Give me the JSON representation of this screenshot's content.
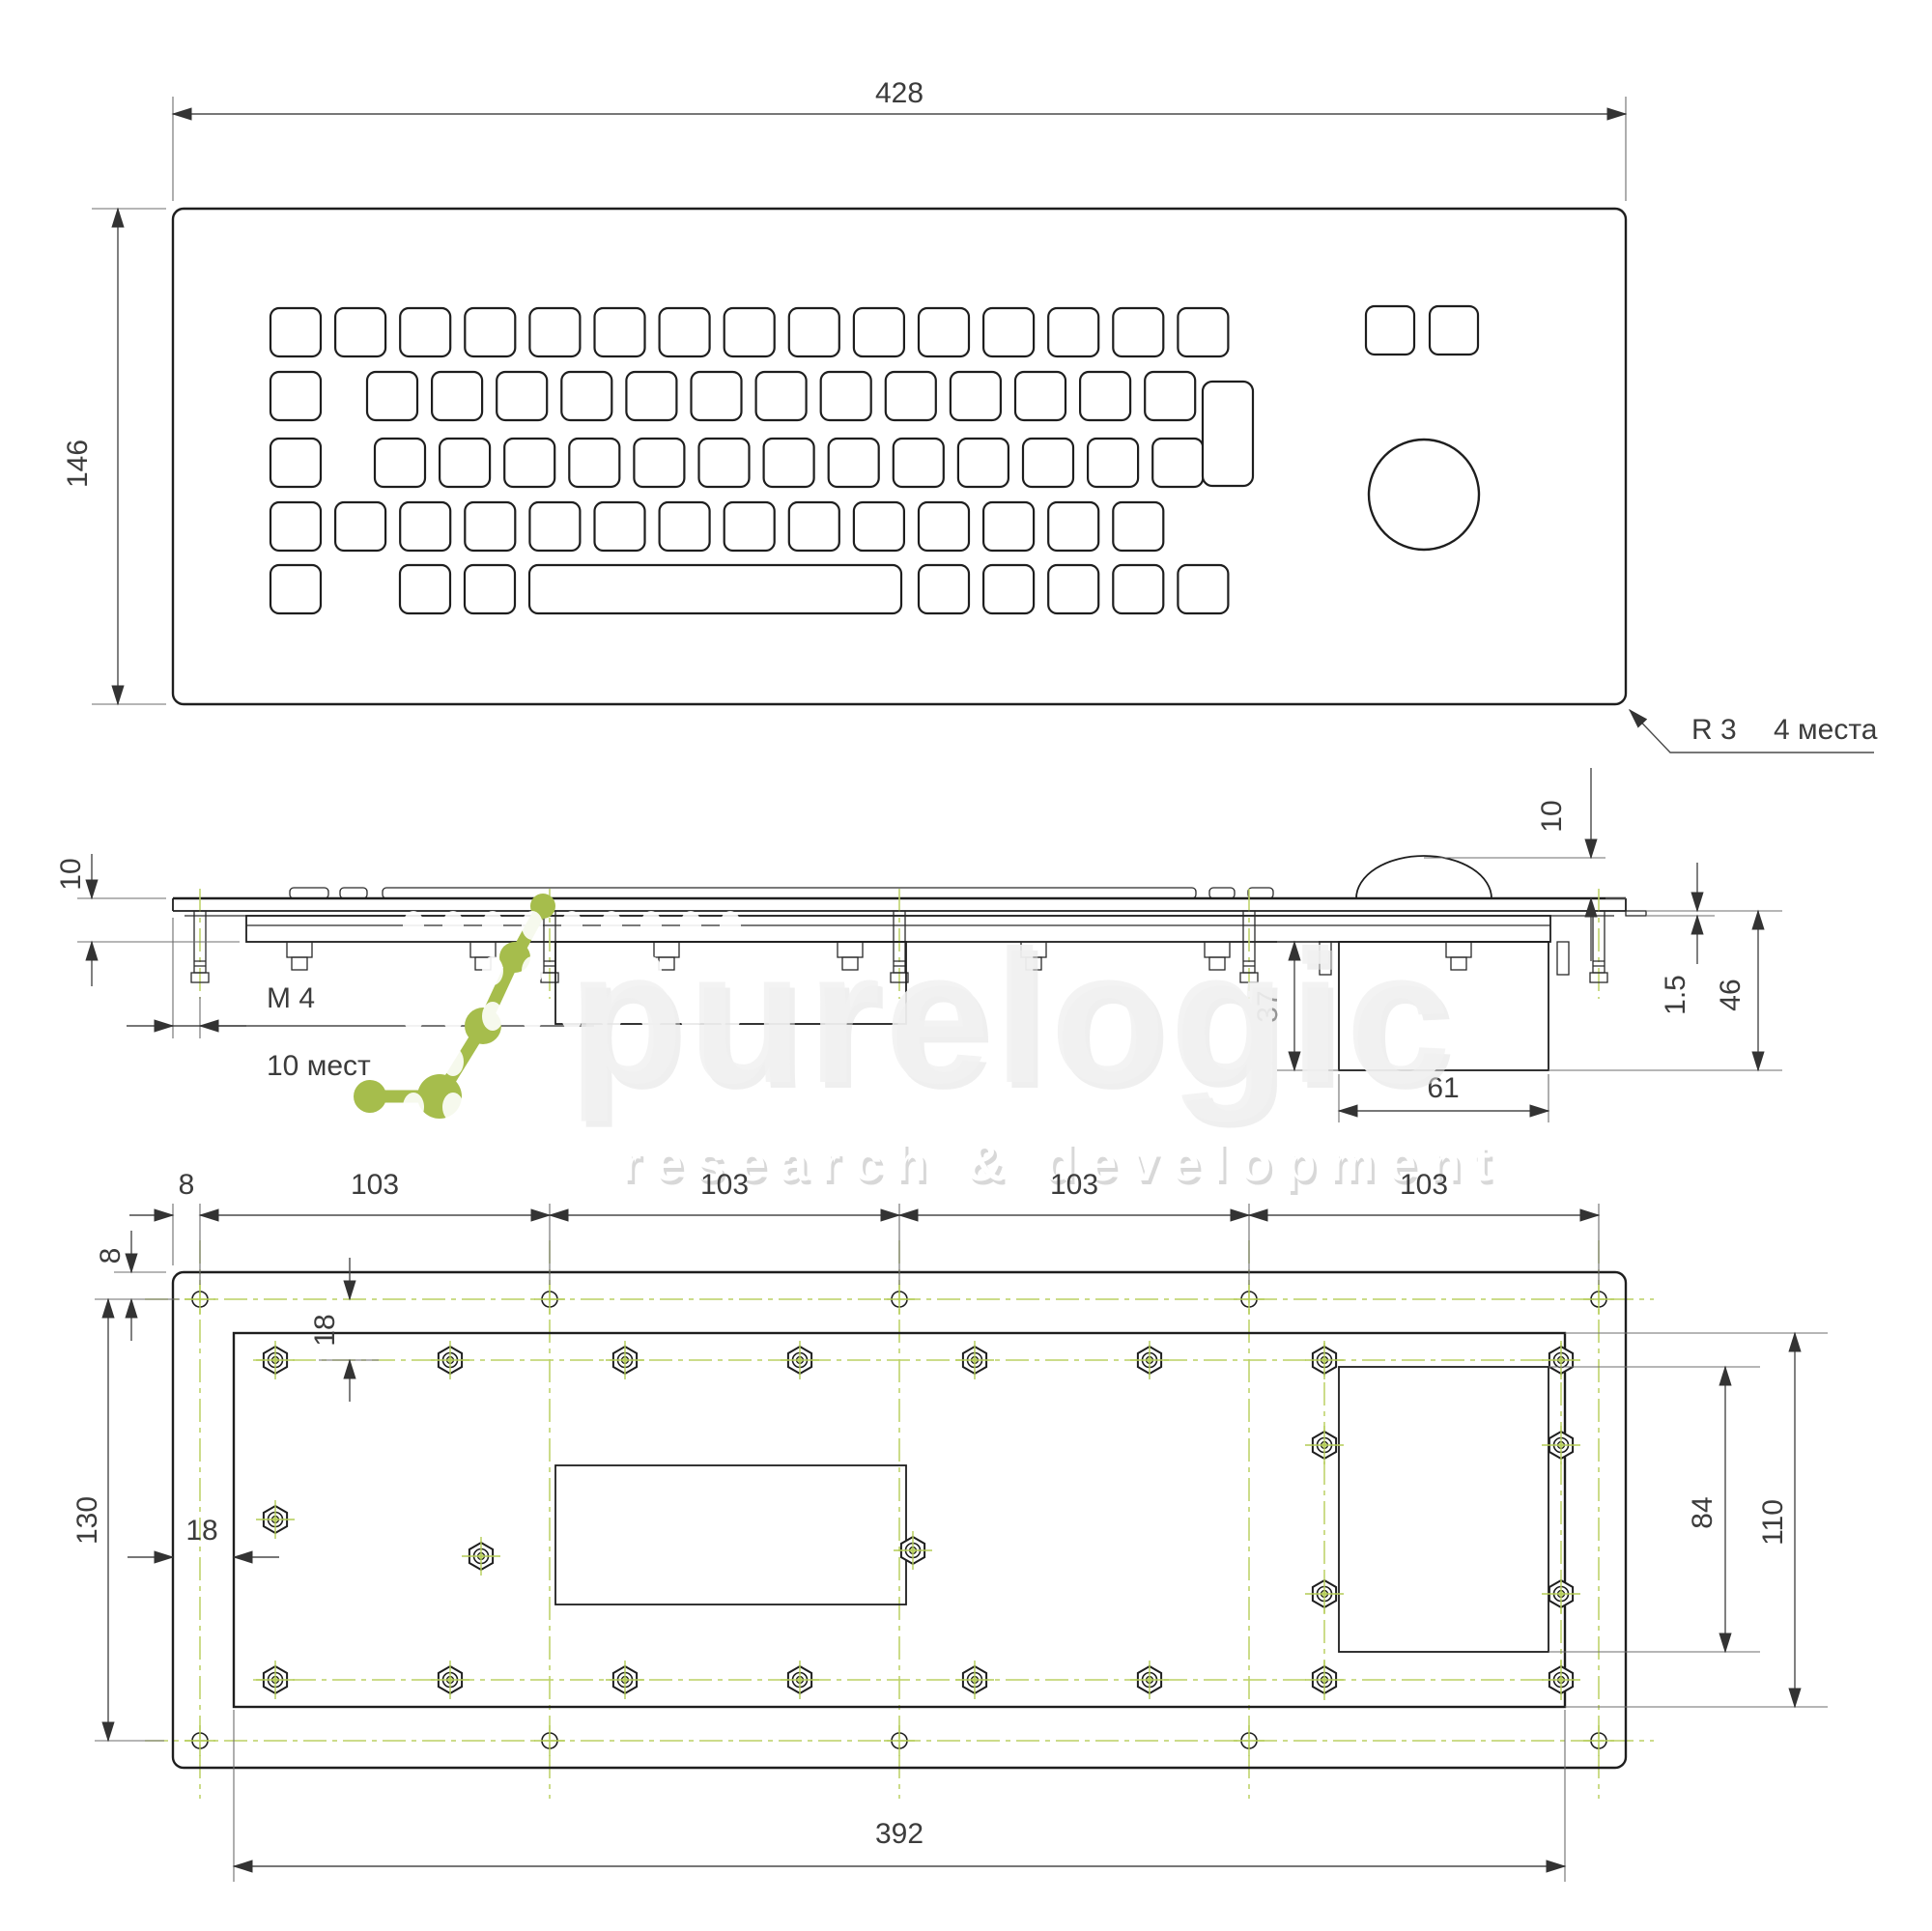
{
  "front_view": {
    "width_label": "428",
    "height_label": "146",
    "corner_radius_label": "R 3",
    "corner_places_label": "4 места"
  },
  "side_view": {
    "stack_height_label": "10",
    "thread_label": "M 4",
    "thread_places_label": "10 мест",
    "dome_height_label": "10",
    "sheet_thickness_label": "1.5",
    "total_depth_label": "46",
    "box_depth_label": "37",
    "box_width_label": "61"
  },
  "back_view": {
    "edge_offset_top_label": "8",
    "hole_pitch_labels": [
      "103",
      "103",
      "103",
      "103"
    ],
    "edge_offset_left_label": "8",
    "screw_row_offset_label": "18",
    "hole_rows_distance_label": "130",
    "plate_inset_label": "18",
    "cutout_height_label": "84",
    "plate_height_label": "110",
    "plate_width_label": "392"
  },
  "watermark": {
    "brand": "purelogic",
    "tagline": "research & development"
  },
  "colors": {
    "centerline_green": "#bcd163",
    "logo_green": "#a6bd4c",
    "watermark_gray": "#f2f2f2",
    "ink": "#1e1e1e"
  }
}
